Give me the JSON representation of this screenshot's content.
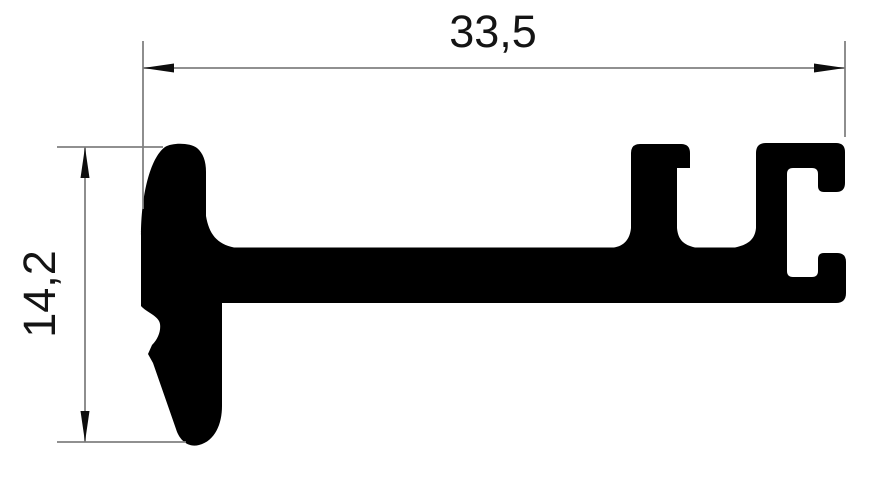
{
  "drawing": {
    "dimensions": {
      "width": {
        "value": "33,5"
      },
      "height": {
        "value": "14,2"
      }
    },
    "colors": {
      "profile": "#000000",
      "dimension_lines": "#818181",
      "arrowheads": "#0d0d0d",
      "dimension_text": "#141414",
      "background": "#ffffff"
    }
  }
}
